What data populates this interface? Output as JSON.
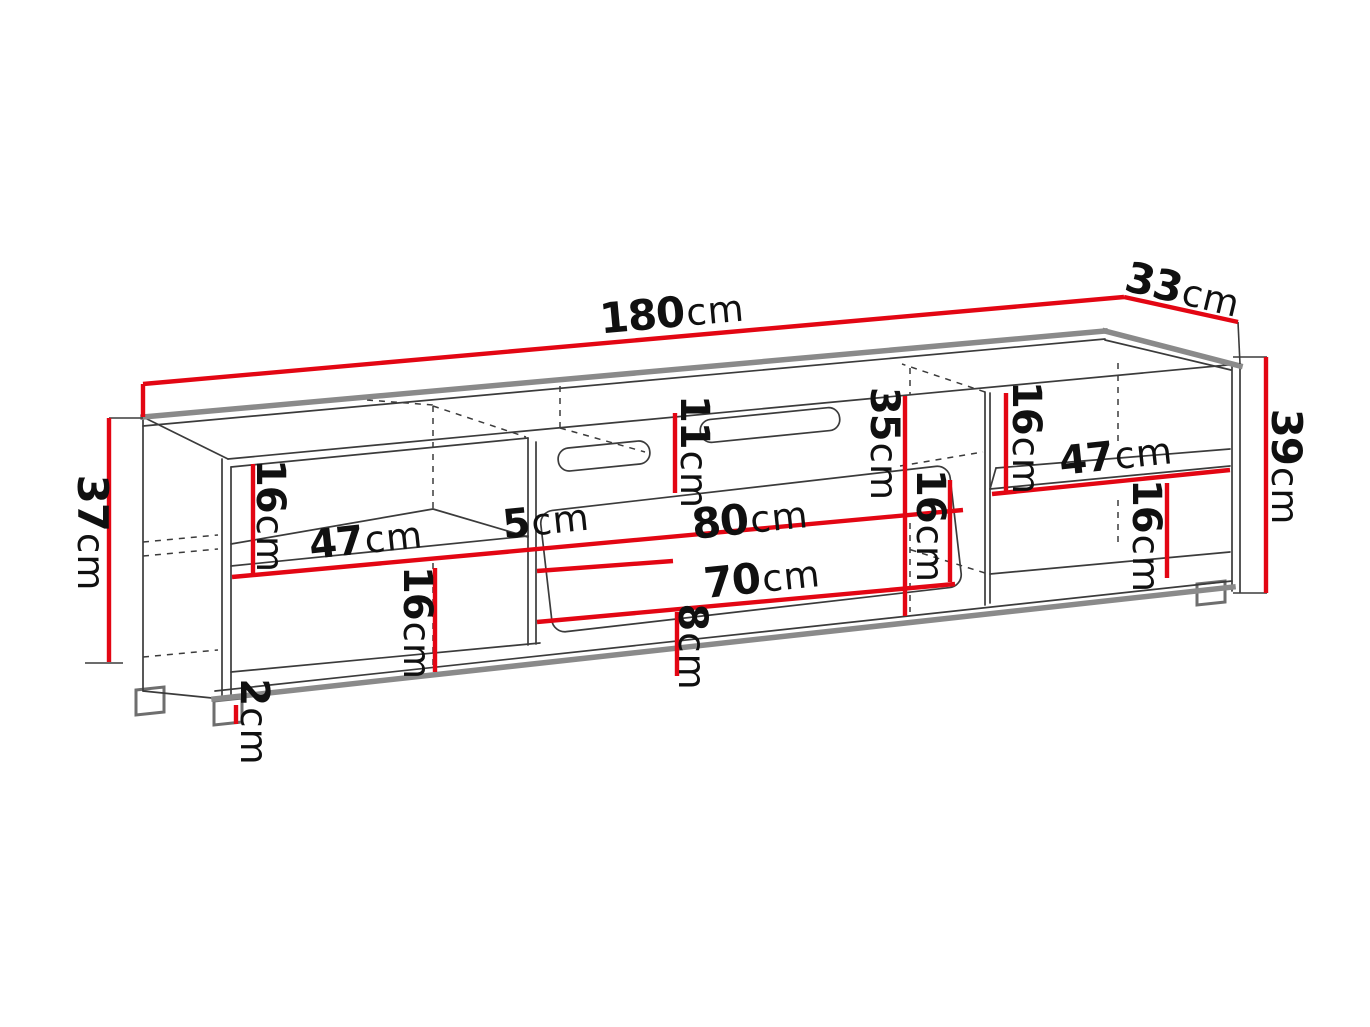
{
  "diagram": {
    "type": "furniture-dimension-drawing",
    "subject": "TV stand / lowboard technical drawing",
    "unit": "cm",
    "colors": {
      "dimension_red": "#e30613",
      "line_dark": "#3b3b3b",
      "edge_gray": "#8a8a8a"
    },
    "labels": {
      "width_total": {
        "num": "180",
        "unit": "cm"
      },
      "depth_total": {
        "num": "33",
        "unit": "cm"
      },
      "height_left": {
        "num": "37",
        "unit": "cm"
      },
      "height_right": {
        "num": "39",
        "unit": "cm"
      },
      "left_upper_gap": {
        "num": "16",
        "unit": "cm"
      },
      "left_shelf_width": {
        "num": "47",
        "unit": "cm"
      },
      "left_lower_gap": {
        "num": "16",
        "unit": "cm"
      },
      "foot_height": {
        "num": "2",
        "unit": "cm"
      },
      "divider_width": {
        "num": "5",
        "unit": "cm"
      },
      "top_rail_height": {
        "num": "11",
        "unit": "cm"
      },
      "door_width": {
        "num": "80",
        "unit": "cm"
      },
      "door_inner_width": {
        "num": "70",
        "unit": "cm"
      },
      "door_bottom_gap": {
        "num": "8",
        "unit": "cm"
      },
      "middle_height": {
        "num": "35",
        "unit": "cm"
      },
      "middle_gap": {
        "num": "16",
        "unit": "cm"
      },
      "right_upper_gap": {
        "num": "16",
        "unit": "cm"
      },
      "right_shelf_width": {
        "num": "47",
        "unit": "cm"
      },
      "right_lower_gap": {
        "num": "16",
        "unit": "cm"
      }
    }
  }
}
